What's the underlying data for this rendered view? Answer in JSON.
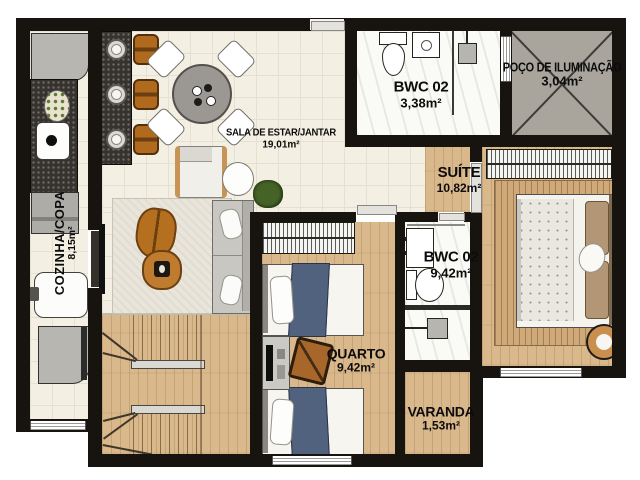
{
  "plan_title": "apartment-floor-plan",
  "rooms": [
    {
      "id": "cozinha",
      "name": "COZINHA/COPA",
      "area": "8,15m²"
    },
    {
      "id": "sala",
      "name": "SALA DE ESTAR/JANTAR",
      "area": "19,01m²"
    },
    {
      "id": "bwc_top",
      "name": "BWC 02",
      "area": "3,38m²"
    },
    {
      "id": "poco",
      "name": "POÇO DE ILUMINAÇÃO",
      "area": "3,04m²"
    },
    {
      "id": "suite",
      "name": "SUÍTE",
      "area": "10,82m²"
    },
    {
      "id": "bwc_mid",
      "name": "BWC 02",
      "area": "9,42m²"
    },
    {
      "id": "quarto",
      "name": "QUARTO",
      "area": "9,42m²"
    },
    {
      "id": "varanda",
      "name": "VARANDA",
      "area": "1,53m²"
    }
  ],
  "colors": {
    "wall": "#17130e",
    "tile_floor": "#f3efe2",
    "wood_floor": "#d9b88b",
    "marble_floor": "#fafaf7",
    "granite_counter": "#36322d",
    "light_well_gray": "#a9a59d",
    "stool_orange": "#b06a1e",
    "bed_blue": "#51627e",
    "rug_beige": "#e9e5da",
    "suite_rug_tan": "#cfa977"
  }
}
